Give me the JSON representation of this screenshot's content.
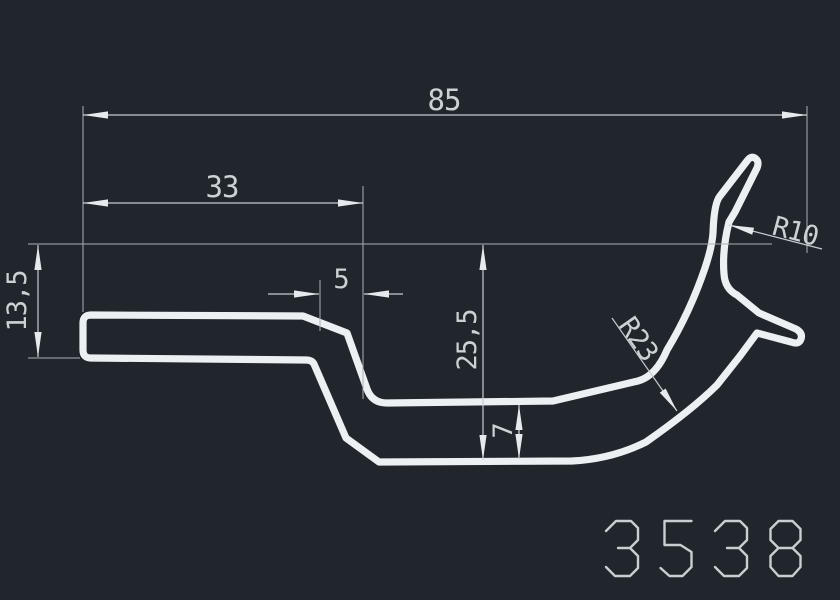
{
  "drawing": {
    "type": "technical-profile-cross-section",
    "part_number": "3538",
    "colors": {
      "background": "#21252c",
      "profile_line": "#edf0f2",
      "dimension_line": "#c6ccd2",
      "text": "#ccd1d6"
    },
    "dimensions": {
      "total_width": "85",
      "left_width": "33",
      "step_width": "5",
      "left_height": "13,5",
      "right_height": "25,5",
      "wall_thickness": "7",
      "radius_small": "R10",
      "radius_large": "R23"
    }
  }
}
